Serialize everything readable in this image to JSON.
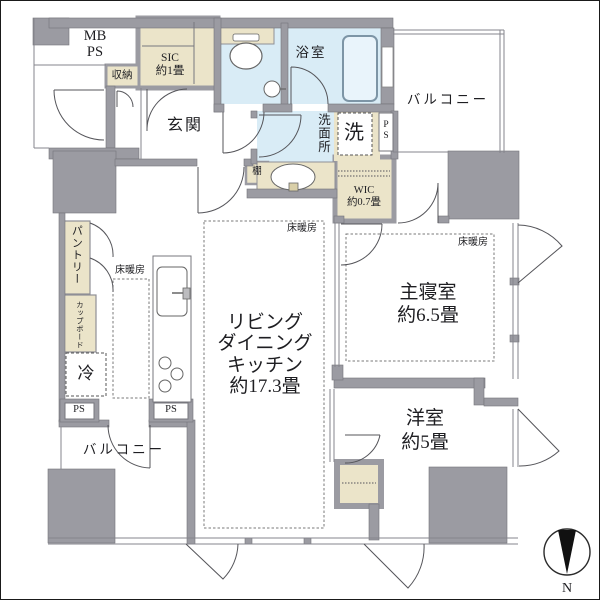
{
  "plan": {
    "rooms": {
      "entrance": "玄関",
      "ldk": "リビング\nダイニング\nキッチン\n約17.3畳",
      "master_bedroom": "主寝室\n約6.5畳",
      "western_room": "洋室\n約5畳",
      "bathroom": "浴室",
      "washroom": "洗面所",
      "balcony_top": "バルコニー",
      "balcony_bottom": "バルコニー"
    },
    "storage": {
      "sic": "SIC\n約1畳",
      "wic": "WIC\n約0.7畳",
      "closet": "収納",
      "shelf": "棚",
      "pantry": "パントリー",
      "cupboard": "カップボード"
    },
    "fixtures": {
      "washer": "洗",
      "fridge": "冷"
    },
    "utility": {
      "mb_ps": "MB\nPS",
      "ps_vertical": "P\nS",
      "ps_left": "PS",
      "ps_right": "PS"
    },
    "floor_heating": "床暖房",
    "compass_north": "N",
    "colors": {
      "wall": "#9b9ba2",
      "tatami_beige": "#ebe4c9",
      "wet_area_blue": "#d9ecf6"
    }
  }
}
